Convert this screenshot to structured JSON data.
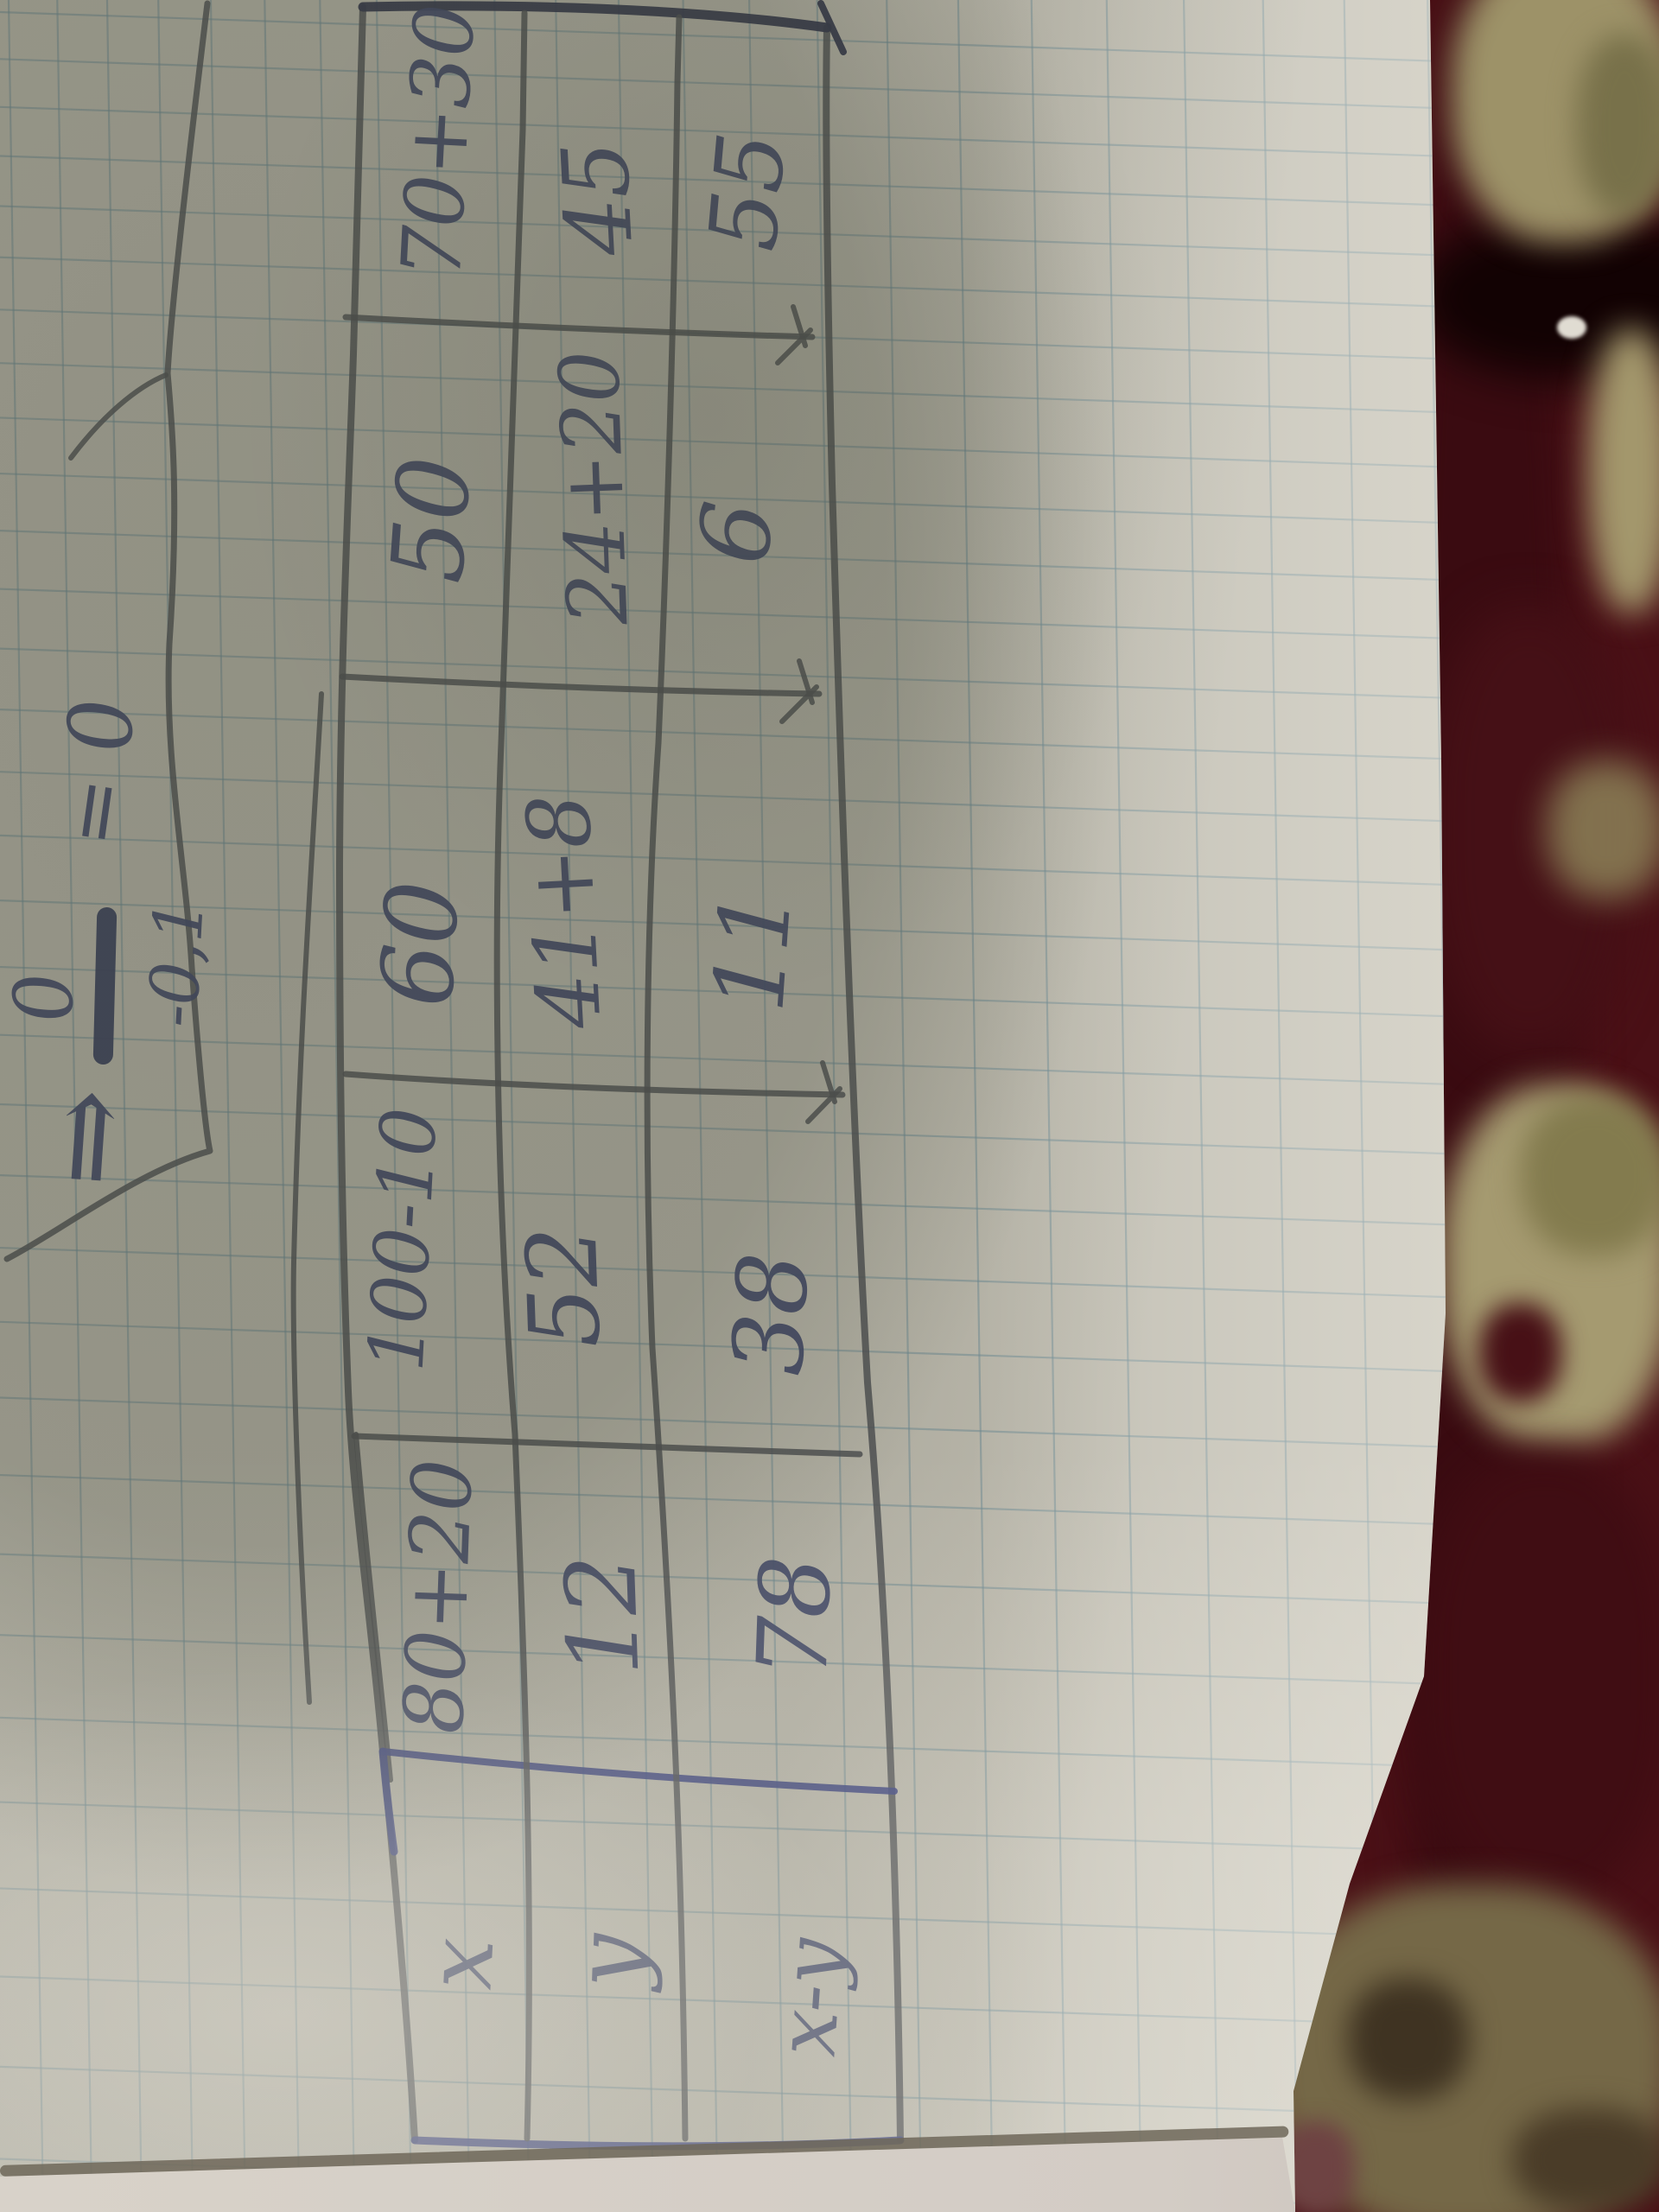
{
  "formula": {
    "arrow": "⇒",
    "numerator": "0",
    "denominator": "-0,1",
    "equals_sign": "=",
    "result": "0"
  },
  "table": {
    "row_labels": {
      "x": "x",
      "y": "y",
      "x_minus_y": "x-y"
    },
    "columns": [
      {
        "x": "80+20",
        "y": "12",
        "x_minus_y": "78"
      },
      {
        "x": "100-10",
        "y": "52",
        "x_minus_y": "38"
      },
      {
        "x": "60",
        "y": "41+8",
        "x_minus_y": "11"
      },
      {
        "x": "50",
        "y": "24+20",
        "x_minus_y": "6"
      },
      {
        "x": "70+30",
        "y": "45",
        "x_minus_y": "55"
      }
    ]
  },
  "colors": {
    "ink_blue": "#3f4668",
    "ink_gray": "#4e4f52",
    "paper_shadowed": "#a7a496",
    "paper_bright": "#ddd9cf",
    "grid_line": "#6c8a94",
    "carpet_base": "#4a1016",
    "carpet_black": "#120203",
    "carpet_beige": "#a59a6e",
    "carpet_olive": "#81784c"
  }
}
